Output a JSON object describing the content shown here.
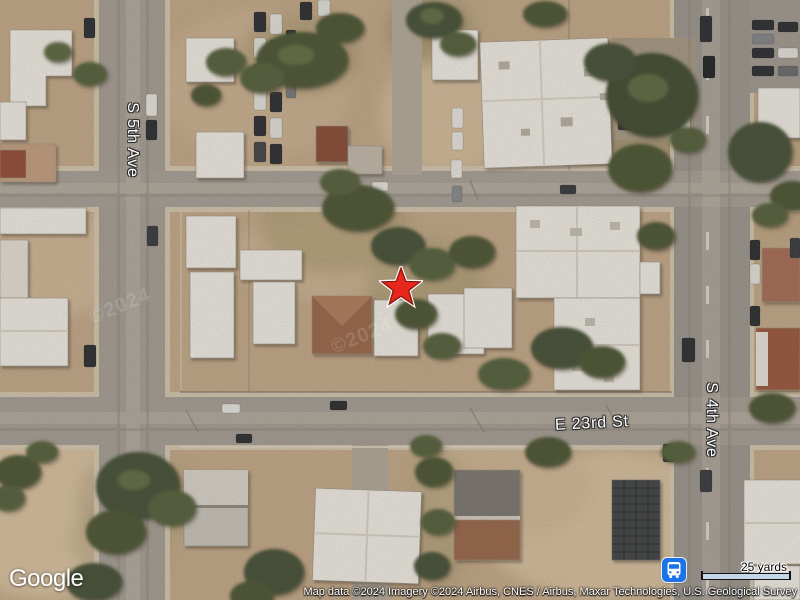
{
  "map": {
    "streets": {
      "s5th_ave": "S 5th Ave",
      "s4th_ave": "S 4th Ave",
      "e23rd_st": "E 23rd St"
    },
    "marker": {
      "shape": "star",
      "fill": "#e8271c",
      "border": "#8e170e",
      "halo": "#ffffff"
    },
    "transit": {
      "icon": "bus-station-icon",
      "color": "#1a73e8"
    },
    "watermark": "©2024"
  },
  "footer": {
    "logo": "Google",
    "attribution": "Map data ©2024 Imagery ©2024 Airbus, CNES / Airbus, Maxar Technologies, U.S. Geological Survey",
    "scale": {
      "label": "25 yards"
    }
  },
  "colors": {
    "sand": "#c3aa8b",
    "road": "#a5a098",
    "building": "#f1efe9",
    "tree": "#4d5939"
  }
}
